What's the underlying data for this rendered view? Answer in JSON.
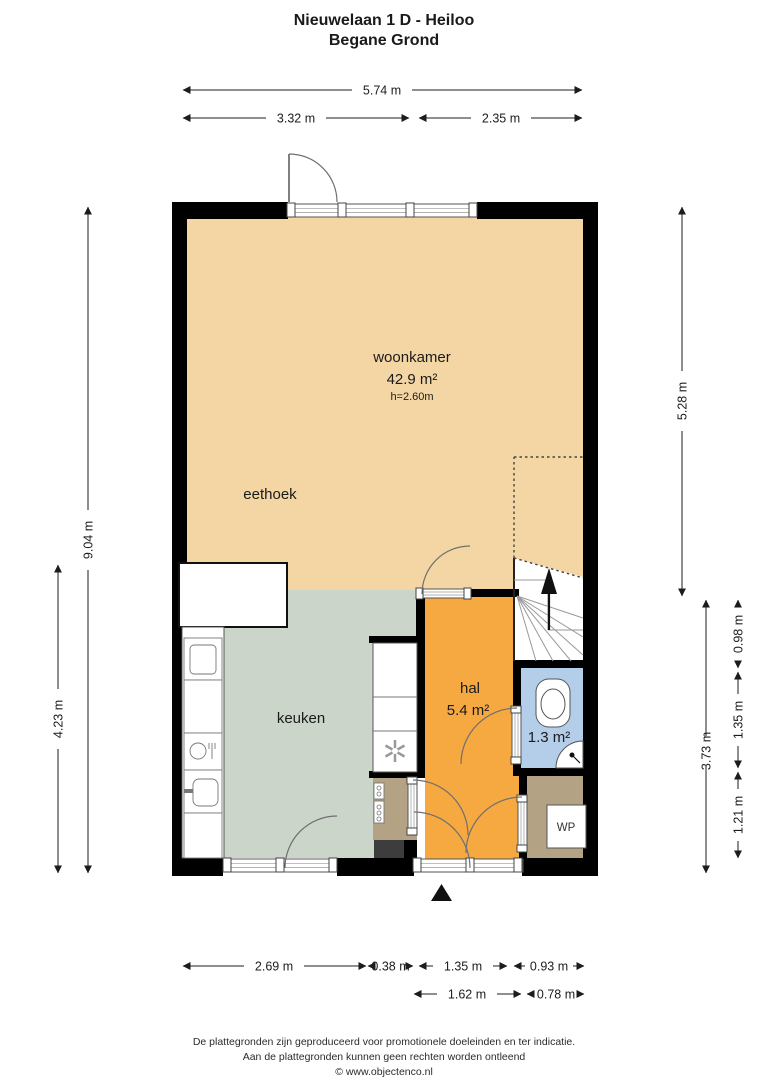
{
  "title": {
    "line1": "Nieuwelaan 1 D - Heiloo",
    "line2": "Begane Grond"
  },
  "rooms": {
    "woonkamer": {
      "name": "woonkamer",
      "area": "42.9 m²",
      "ceiling": "h=2.60m"
    },
    "eethoek": {
      "name": "eethoek"
    },
    "keuken": {
      "name": "keuken"
    },
    "hal": {
      "name": "hal",
      "area": "5.4 m²"
    },
    "toilet": {
      "area": "1.3 m²"
    },
    "wp": {
      "label": "WP"
    }
  },
  "dims": {
    "top": {
      "total": "5.74 m",
      "left": "3.32 m",
      "right": "2.35 m"
    },
    "left": {
      "total": "9.04 m",
      "partial": "4.23 m"
    },
    "right": {
      "upper": "5.28 m",
      "lower": "3.73 m",
      "seg_top": "0.98 m",
      "seg_mid": "1.35 m",
      "seg_bottom": "1.21 m"
    },
    "bottom": {
      "row1": [
        "2.69 m",
        "0.38 m",
        "1.35 m",
        "0.93 m"
      ],
      "row2": [
        "1.62 m",
        "0.78 m"
      ]
    }
  },
  "footer": {
    "line1": "De plattegronden zijn geproduceerd voor promotionele doeleinden en ter indicatie.",
    "line2": "Aan de plattegronden kunnen geen rechten worden ontleend",
    "line3": "© www.objectenco.nl"
  },
  "colors": {
    "wall": "#000000",
    "living": "#f3d6a4",
    "kitchen": "#cbd5ca",
    "hall": "#f6a841",
    "toilet": "#b4cde8",
    "utility": "#b4a284",
    "dark_unit": "#3d3d3d"
  }
}
